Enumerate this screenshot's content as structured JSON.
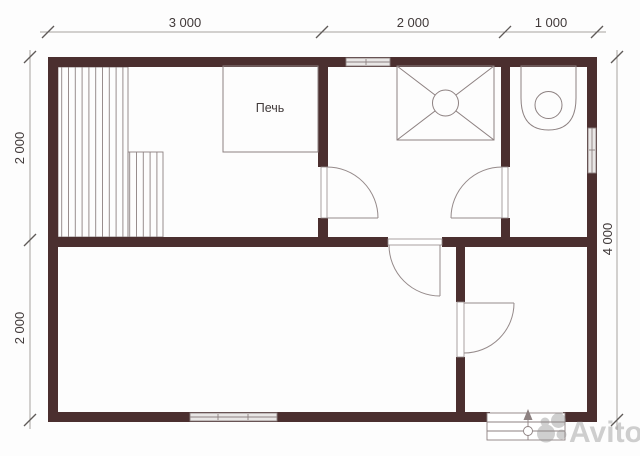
{
  "plan": {
    "type": "floor-plan",
    "dimensions": {
      "top": [
        "3 000",
        "2 000",
        "1 000"
      ],
      "left": [
        "2 000",
        "2 000"
      ],
      "right": [
        "4 000"
      ]
    },
    "fixtures": {
      "stove_label": "Печь"
    },
    "watermark": {
      "brand": "Avito"
    },
    "colors": {
      "wall": "#4b2f2f",
      "fixture_line": "#8d8181",
      "dimension_line": "#a8a2a0",
      "tick": "#5f5a58",
      "text": "#413a3a",
      "window_fill": "#e9e7e6",
      "watermark": "#8f8f8f",
      "background": "#fdfdfd"
    }
  }
}
